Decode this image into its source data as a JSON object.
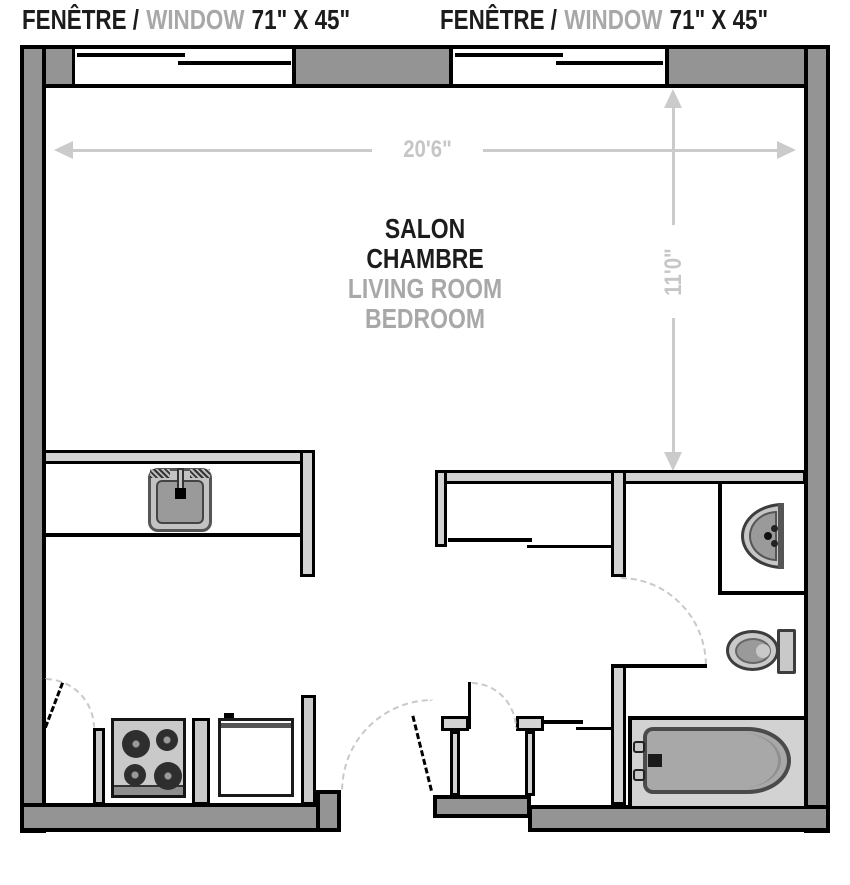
{
  "labels": {
    "windows": [
      {
        "fr": "FENÊTRE /",
        "en": "WINDOW",
        "size": "71\" X 45\""
      },
      {
        "fr": "FENÊTRE /",
        "en": "WINDOW",
        "size": "71\" X 45\""
      }
    ],
    "room": {
      "fr1": "SALON",
      "fr2": "CHAMBRE",
      "en1": "LIVING ROOM",
      "en2": "BEDROOM"
    },
    "dimensions": {
      "width": "20'6\"",
      "height": "11'0\""
    }
  },
  "colors": {
    "wall_gray": "#949494",
    "partition_gray": "#d2d2d2",
    "outline_black": "#000000",
    "dimension_gray": "#cbcbcb",
    "label_gray": "#a8a8a8",
    "label_black": "#1c1c1c",
    "fixture_outline": "#4a4a4a",
    "fixture_fill": "#a8a8a8"
  },
  "fixtures": {
    "kitchen": [
      "kitchen-sink",
      "stove",
      "refrigerator"
    ],
    "bathroom": [
      "bathroom-sink",
      "toilet",
      "bathtub"
    ],
    "doors": [
      "kitchen-closet-door",
      "entry-door",
      "hall-closet-door",
      "bathroom-door"
    ],
    "windows": [
      "window-71x45-left",
      "window-71x45-right"
    ]
  }
}
